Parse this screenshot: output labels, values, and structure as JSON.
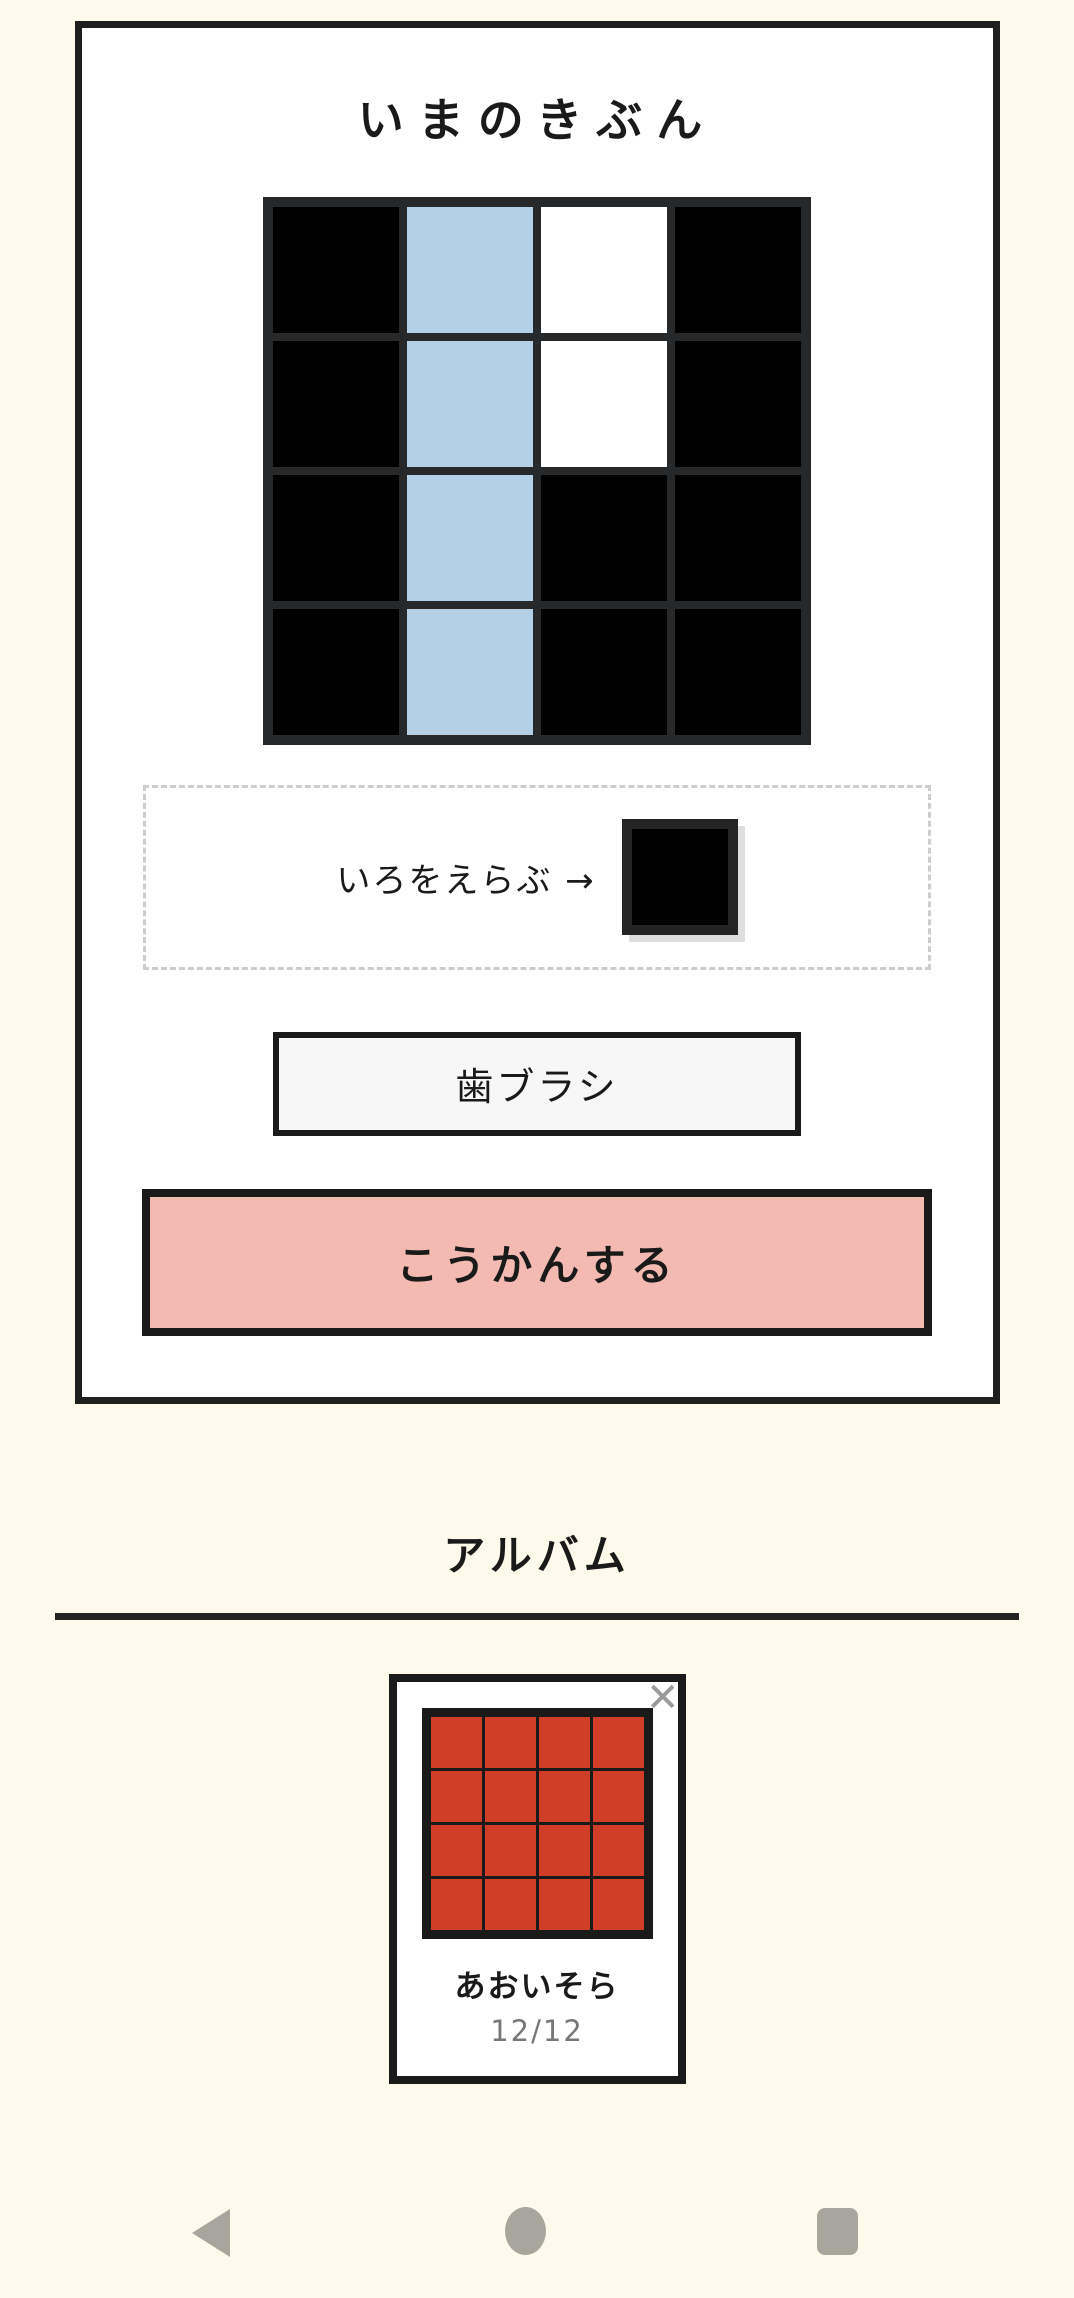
{
  "screen": {
    "background_color": "#fdfaeb"
  },
  "mood_panel": {
    "title": "いまのきぶん",
    "grid": {
      "rows": 4,
      "cols": 4,
      "palette": {
        "black": "#000000",
        "blue": "#b4d0e6",
        "white": "#ffffff"
      },
      "cells": [
        [
          "black",
          "blue",
          "white",
          "black"
        ],
        [
          "black",
          "blue",
          "white",
          "black"
        ],
        [
          "black",
          "blue",
          "black",
          "black"
        ],
        [
          "black",
          "blue",
          "black",
          "black"
        ]
      ]
    },
    "color_picker": {
      "label": "いろをえらぶ →",
      "selected_color": "#000000"
    },
    "name_button_label": "歯ブラシ",
    "exchange_button": {
      "label": "こうかんする",
      "background_color": "#f3bab2"
    }
  },
  "album": {
    "heading": "アルバム",
    "items": [
      {
        "title": "あおいそら",
        "count": "12/12",
        "close_icon": "✕",
        "thumbnail_grid": {
          "rows": 4,
          "cols": 4,
          "fill": "#d03e28"
        }
      }
    ]
  },
  "navigation": {
    "icons": [
      "back",
      "home",
      "recents"
    ],
    "icon_color": "#a8a59d"
  }
}
